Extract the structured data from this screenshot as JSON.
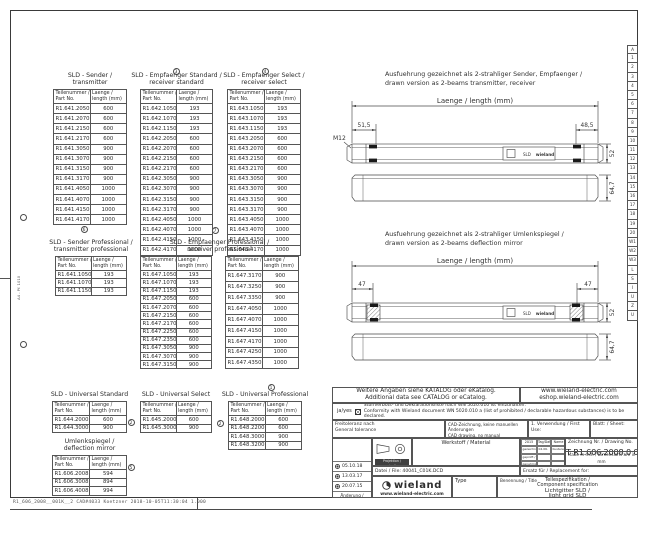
{
  "frame": {
    "footer_text": "R1_606_2008__001K__2  CAD#4033 Koetzner  2018-10-05T11:30:04  1.000",
    "margin_label": "A4 - Pf. 1010"
  },
  "index_strip": [
    "A",
    "1",
    "2",
    "3",
    "4",
    "5",
    "6",
    "7",
    "8",
    "9",
    "10",
    "11",
    "12",
    "13",
    "14",
    "15",
    "16",
    "17",
    "18",
    "19",
    "20",
    "W1",
    "W2",
    "W3",
    "L",
    "S",
    "I",
    "U",
    "Z",
    "U"
  ],
  "headers": {
    "col1a": "Teilenummer /",
    "col1b": "Part No.",
    "col2a": "Laenge /",
    "col2b": "length (mm)"
  },
  "tables": [
    {
      "title1": "SLD - Sender /",
      "title2": "transmitter",
      "rows": [
        [
          "R1.641.2050.0",
          "600"
        ],
        [
          "R1.641.2070.0",
          "600"
        ],
        [
          "R1.641.2150.0",
          "600"
        ],
        [
          "R1.641.2170.0",
          "600"
        ],
        [
          "R1.641.3050.0",
          "900"
        ],
        [
          "R1.641.3070.0",
          "900"
        ],
        [
          "R1.641.3150.0",
          "900"
        ],
        [
          "R1.641.3170.0",
          "900"
        ],
        [
          "R1.641.4050.0",
          "1000"
        ],
        [
          "R1.641.4070.0",
          "1000"
        ],
        [
          "R1.641.4150.0",
          "1000"
        ],
        [
          "R1.641.4170.0",
          "1000"
        ]
      ]
    },
    {
      "title1": "SLD - Empfaenger Standard /",
      "title2": "receiver standard",
      "rows": [
        [
          "R1.642.1050.0",
          "193"
        ],
        [
          "R1.642.1070.0",
          "193"
        ],
        [
          "R1.642.1150.0",
          "193"
        ],
        [
          "R1.642.2050.0",
          "600"
        ],
        [
          "R1.642.2070.0",
          "600"
        ],
        [
          "R1.642.2150.0",
          "600"
        ],
        [
          "R1.642.2170.0",
          "600"
        ],
        [
          "R1.642.3050.0",
          "900"
        ],
        [
          "R1.642.3070.0",
          "900"
        ],
        [
          "R1.642.3150.0",
          "900"
        ],
        [
          "R1.642.3170.0",
          "900"
        ],
        [
          "R1.642.4050.0",
          "1000"
        ],
        [
          "R1.642.4070.0",
          "1000"
        ],
        [
          "R1.642.4150.0",
          "1000"
        ],
        [
          "R1.642.4170.0",
          "1000"
        ]
      ]
    },
    {
      "title1": "SLD - Empfaenger Select /",
      "title2": "receiver select",
      "rows": [
        [
          "R1.643.1050.0",
          "193"
        ],
        [
          "R1.643.1070.0",
          "193"
        ],
        [
          "R1.643.1150.0",
          "193"
        ],
        [
          "R1.643.2050.0",
          "600"
        ],
        [
          "R1.643.2070.0",
          "600"
        ],
        [
          "R1.643.2150.0",
          "600"
        ],
        [
          "R1.643.2170.0",
          "600"
        ],
        [
          "R1.643.3050.0",
          "900"
        ],
        [
          "R1.643.3070.0",
          "900"
        ],
        [
          "R1.643.3150.0",
          "900"
        ],
        [
          "R1.643.3170.0",
          "900"
        ],
        [
          "R1.643.4050.0",
          "1000"
        ],
        [
          "R1.643.4070.0",
          "1000"
        ],
        [
          "R1.643.4150.0",
          "1000"
        ],
        [
          "R1.643.4170.0",
          "1000"
        ]
      ]
    },
    {
      "title1": "SLD - Sender Professional /",
      "title2": "transmitter professional",
      "rows": [
        [
          "R1.641.1050.0",
          "193"
        ],
        [
          "R1.641.1070.0",
          "193"
        ],
        [
          "R1.641.1150.0",
          "193"
        ]
      ]
    },
    {
      "title1": "SLD - Empfaenger Professional /",
      "title2": "receiver professional",
      "rows": [
        [
          "R1.647.1050.0",
          "193"
        ],
        [
          "R1.647.1070.0",
          "193"
        ],
        [
          "R1.647.1150.0",
          "193"
        ],
        [
          "R1.647.2050.0",
          "600"
        ],
        [
          "R1.647.2070.0",
          "600"
        ],
        [
          "R1.647.2150.0",
          "600"
        ],
        [
          "R1.647.2170.0",
          "600"
        ],
        [
          "R1.647.2250.0",
          "600"
        ],
        [
          "R1.647.2350.0",
          "600"
        ],
        [
          "R1.647.3050.0",
          "900"
        ],
        [
          "R1.647.3070.0",
          "900"
        ],
        [
          "R1.647.3150.0",
          "900"
        ]
      ],
      "rows_b": [
        [
          "R1.647.3170.0",
          "900"
        ],
        [
          "R1.647.3250.0",
          "900"
        ],
        [
          "R1.647.3350.0",
          "900"
        ],
        [
          "R1.647.4050.0",
          "1000"
        ],
        [
          "R1.647.4070.0",
          "1000"
        ],
        [
          "R1.647.4150.0",
          "1000"
        ],
        [
          "R1.647.4170.0",
          "1000"
        ],
        [
          "R1.647.4250.0",
          "1000"
        ],
        [
          "R1.647.4350.0",
          "1000"
        ]
      ]
    },
    {
      "title1": "SLD - Universal Standard",
      "title2": "",
      "rows": [
        [
          "R1.644.2000.0",
          "600"
        ],
        [
          "R1.644.3000.0",
          "900"
        ]
      ]
    },
    {
      "title1": "SLD - Universal Select",
      "title2": "",
      "rows": [
        [
          "R1.645.2000.0",
          "600"
        ],
        [
          "R1.645.3000.0",
          "900"
        ]
      ]
    },
    {
      "title1": "SLD - Universal Professional",
      "title2": "",
      "rows": [
        [
          "R1.648.2000.0",
          "600"
        ],
        [
          "R1.648.2200.0",
          "600"
        ],
        [
          "R1.648.3000.0",
          "900"
        ],
        [
          "R1.648.3200.0",
          "900"
        ]
      ]
    },
    {
      "title1": "Umlenkspiegel /",
      "title2": "deflection mirror",
      "rows": [
        [
          "R1.606.2008.0",
          "594"
        ],
        [
          "R1.606.3008.0",
          "894"
        ],
        [
          "R1.606.4008.0",
          "994"
        ]
      ]
    }
  ],
  "markers": [
    {
      "v": "3",
      "x": 176,
      "y": 71
    },
    {
      "v": "4",
      "x": 265,
      "y": 71
    },
    {
      "v": "6",
      "x": 84,
      "y": 229
    },
    {
      "v": "7",
      "x": 215,
      "y": 230
    },
    {
      "v": "1",
      "x": 271,
      "y": 387
    },
    {
      "v": "2",
      "x": 131,
      "y": 422
    },
    {
      "v": "2",
      "x": 220,
      "y": 423
    },
    {
      "v": "5",
      "x": 131,
      "y": 467
    }
  ],
  "drawings": {
    "d1": {
      "note_de": "Ausfuehrung gezeichnet als 2-strahliger Sender, Empfaenger /",
      "note_en": "drawn version as 2-beams transmitter, receiver",
      "length_label": "Laenge / length (mm)",
      "dim_left": "51,5",
      "dim_right": "48,5",
      "thread": "M12",
      "height": "52",
      "depth": "64,7",
      "plate_text": "SLD",
      "plate_brand": "wieland"
    },
    "d2": {
      "note_de": "Ausfuehrung gezeichnet als 2-strahliger Umlenkspiegel /",
      "note_en": "drawn version as 2-beams deflection mirror",
      "length_label": "Laenge / length (mm)",
      "dim_left": "47",
      "dim_right": "47",
      "height": "52",
      "depth": "64,7",
      "plate_text": "SLD",
      "plate_brand": "wieland"
    }
  },
  "titleblock": {
    "catalog_de": "Weitere Angaben siehe KATALOG oder eKatalog.",
    "catalog_en": "Additional data see CATALOG or eCatalog.",
    "url1": "www.wieland-electric.com",
    "url2": "eshop.wieland-electric.com",
    "ja_yes": "ja/yes",
    "conformity_de": "Stoffverbots- und Deklarationsliste nach WN 5020.010 ist einzuhalten.",
    "conformity_en": "Conformity with Wieland document WN 5020.010 a (list of prohibited / declarable hazardous substances) is to be declared.",
    "tolerance_de": "Freitoleranz nach",
    "tolerance_en": "General tolerance",
    "cad_de": "CAD-Zeichnung, keine manuellen Änderungen",
    "cad_en": "CAD drawing, no manual modifications allowed",
    "first_use": "1. Verwendung / First Use:",
    "sheet": "Blatt: / Sheet:",
    "material": "Werkstoff / Material",
    "projection": "Projektion / projection",
    "grid": {
      "header": [
        "2015",
        "Tag/Date",
        "Name"
      ],
      "rows": [
        [
          "gezeichnet / drawn",
          "04.06.",
          "Kusterer"
        ],
        [
          "geprüft / checked",
          "",
          ""
        ],
        [
          "genehmigt / approved",
          "",
          ""
        ],
        [
          "Norm / standard",
          "",
          ""
        ]
      ]
    },
    "drawing_no_label": "Zeichnung Nr. / Drawing No.",
    "drawing_no": "T R1.606.2008.0 01K",
    "dims_note": "Maße in mm / Dimensions are in mm",
    "file": "Datei / File: 40041_C01K.DCD",
    "replacement": "Ersatz für / Replacement for:",
    "revisions": [
      "05.10.18",
      "13.03.17",
      "20.07.15"
    ],
    "revision_caption": "Änderung / Revision",
    "type_label": "Type",
    "title_label": "Benennung / Title",
    "title1": "Teilespezifikation /",
    "title2": "Component specification",
    "title3": "Lichtgitter SLD /",
    "title4": "light grid SLD",
    "brand": "wieland",
    "brand_url": "www.wieland-electric.com"
  }
}
